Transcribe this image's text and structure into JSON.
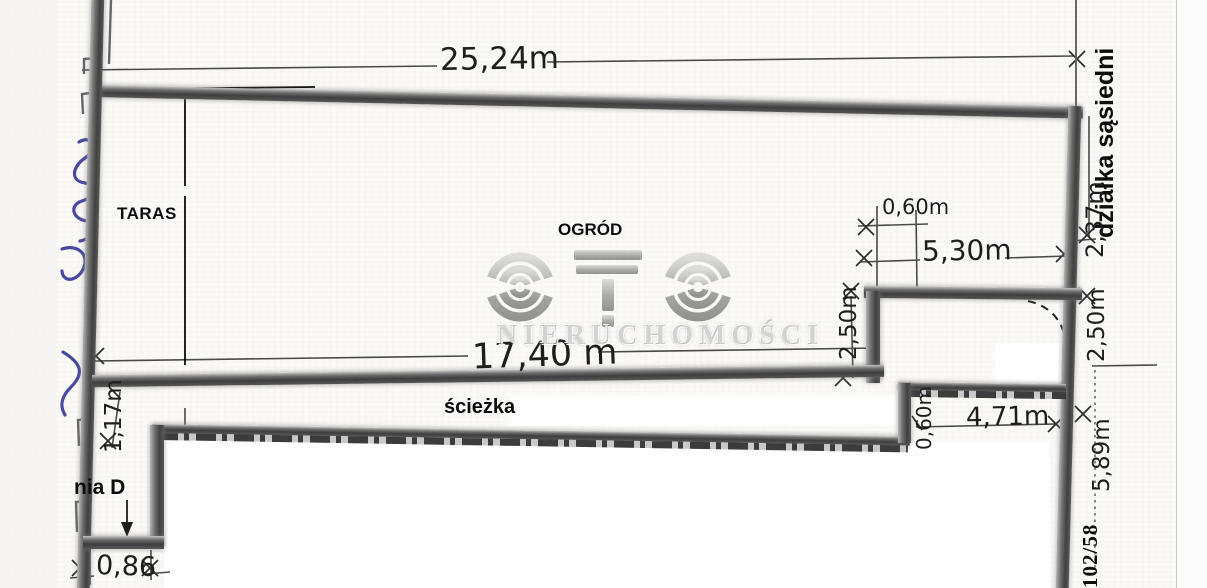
{
  "labels": {
    "taras": "TARAS",
    "ogrod": "OGRÓD",
    "sciezka": "ścieżka",
    "building_fragment": "nia D",
    "neighbor_plot": "działka sąsiedni",
    "plot_number": "102/58"
  },
  "dimensions": {
    "top_width": "25,24m",
    "garden_width": "17,40 m",
    "step_offset_top": "0,60m",
    "step_wall": "5,30m",
    "step_depth_left": "2,50m",
    "right_upper": "2,37m",
    "right_mid": "2,50m",
    "right_lower": "5,89m",
    "lower_step_width": "4,71m",
    "lower_step_offset": "0,60m",
    "left_lower": "1,17m",
    "bottom_left": "0,86"
  },
  "watermark": {
    "brand_logo": "OTO",
    "subtitle": "NIERUCHOMOŚCI"
  },
  "colors": {
    "wall_dark": "#3e3e3e",
    "wall_light": "#b5b5b5",
    "ink": "#1e1e1e",
    "pen_blue": "#3a3a97",
    "watermark_gray": "#9b9b9b",
    "paper": "#fbfaf7"
  }
}
